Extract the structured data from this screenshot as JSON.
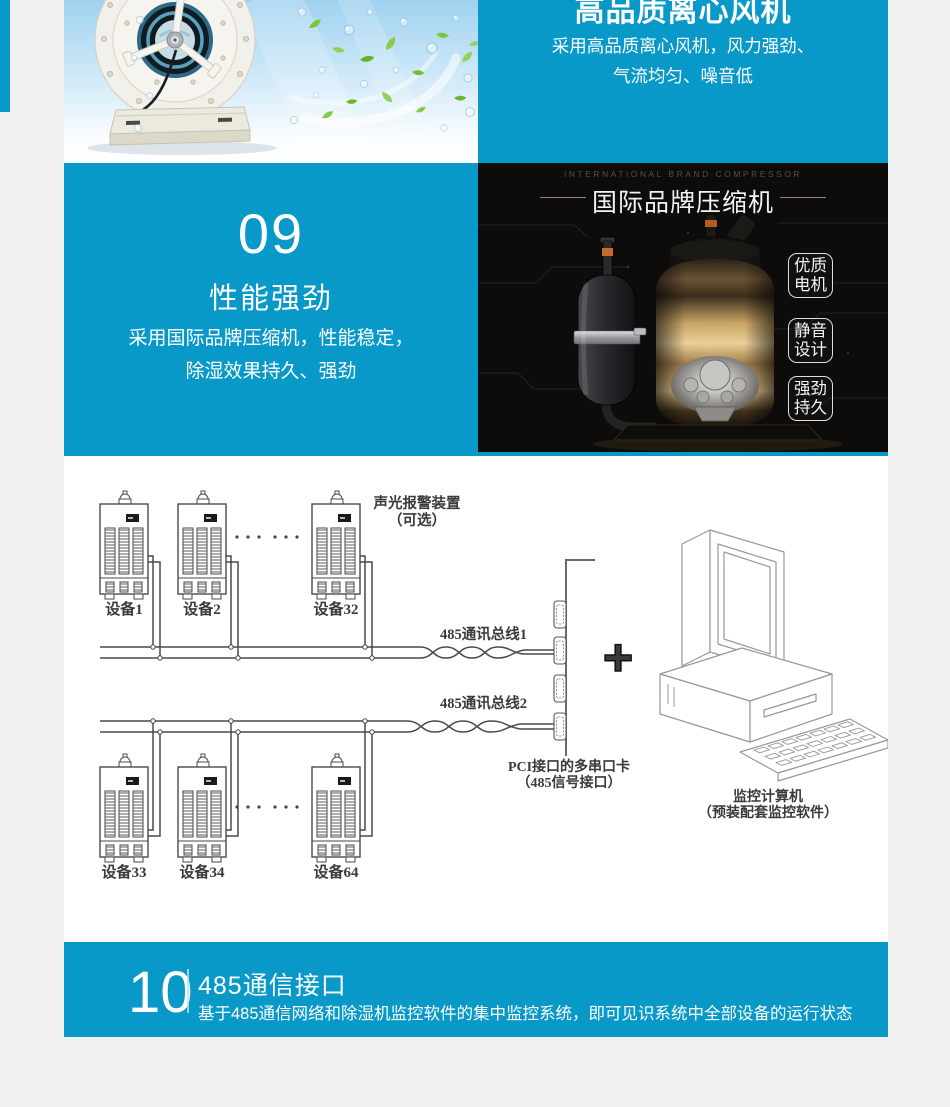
{
  "page": {
    "background": "#f1f1f1",
    "accent_blue": "#0999c9",
    "dark_bg": "#0d0c0a"
  },
  "fan_section": {
    "title": "高品质离心风机",
    "line1": "采用高品质离心风机，风力强劲、",
    "line2": "气流均匀、噪音低"
  },
  "perf_section": {
    "number": "09",
    "title": "性能强劲",
    "line1": "采用国际品牌压缩机，性能稳定，",
    "line2": "除湿效果持久、强劲"
  },
  "compressor": {
    "subtitle_en": "INTERNATIONAL BRAND COMPRESSOR",
    "title": "国际品牌压缩机",
    "badges": [
      {
        "line1": "优质",
        "line2": "电机"
      },
      {
        "line1": "静音",
        "line2": "设计"
      },
      {
        "line1": "强劲",
        "line2": "持久"
      }
    ]
  },
  "diagram": {
    "alarm_label_line1": "声光报警装置",
    "alarm_label_line2": "（可选）",
    "devices": [
      "设备1",
      "设备2",
      "设备32",
      "设备33",
      "设备34",
      "设备64"
    ],
    "bus1_label": "485通讯总线1",
    "bus2_label": "485通讯总线2",
    "plus_symbol": "+",
    "card_label_line1": "PCI接口的多串口卡",
    "card_label_line2": "（485信号接口）",
    "computer_label_line1": "监控计算机",
    "computer_label_line2": "（预装配套监控软件）"
  },
  "comm_section": {
    "number": "10",
    "title": "485通信接口",
    "body": "基于485通信网络和除湿机监控软件的集中监控系统，即可见识系统中全部设备的运行状态"
  }
}
